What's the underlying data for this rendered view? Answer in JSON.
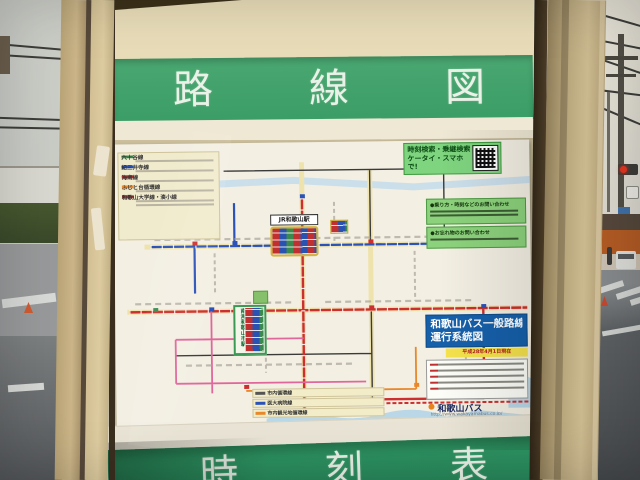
{
  "photo": {
    "board": {
      "top_panel": {
        "chars": [
          "路",
          "線",
          "図"
        ]
      },
      "bottom_panel": {
        "chars": [
          "時",
          "刻",
          "表"
        ]
      }
    },
    "poster": {
      "qr_box": {
        "line1": "時刻検索・乗継検索",
        "line2": "ケータイ・スマホで!"
      },
      "contact_boxes": [
        {
          "title": "●乗り方・時刻などのお問い合わせ"
        },
        {
          "title": "●お忘れ物のお問い合わせ"
        }
      ],
      "title_box": {
        "line1": "和歌山バス一般路線",
        "line2": "運行系統図",
        "date": "平成28年4月1日現在"
      },
      "logo": {
        "company": "和歌山バス",
        "url": "http://www.wakayamabus.co.jp/"
      },
      "stations": {
        "jr": "JR和歌山駅",
        "nankai": "南海和歌山市駅"
      },
      "legend_top": {
        "entries": [
          {
            "name": "六十谷線"
          },
          {
            "name": "紀三井寺線"
          },
          {
            "name": "海南線"
          },
          {
            "name": "ふじと台循環線"
          },
          {
            "name": "和歌山大学線・湊小線"
          }
        ]
      },
      "legend_bottom": {
        "entries": [
          {
            "name": "市内循環線"
          },
          {
            "name": "医大病院線"
          },
          {
            "name": "市内観光地循環線"
          }
        ]
      }
    },
    "colors": {
      "panel_green": "#3fa06a",
      "title_blue": "#1660aa",
      "qr_green": "#7fd47f",
      "route_red": "#cc2f2f",
      "route_blue": "#2a52b8",
      "case_beige": "#d2c094"
    }
  }
}
